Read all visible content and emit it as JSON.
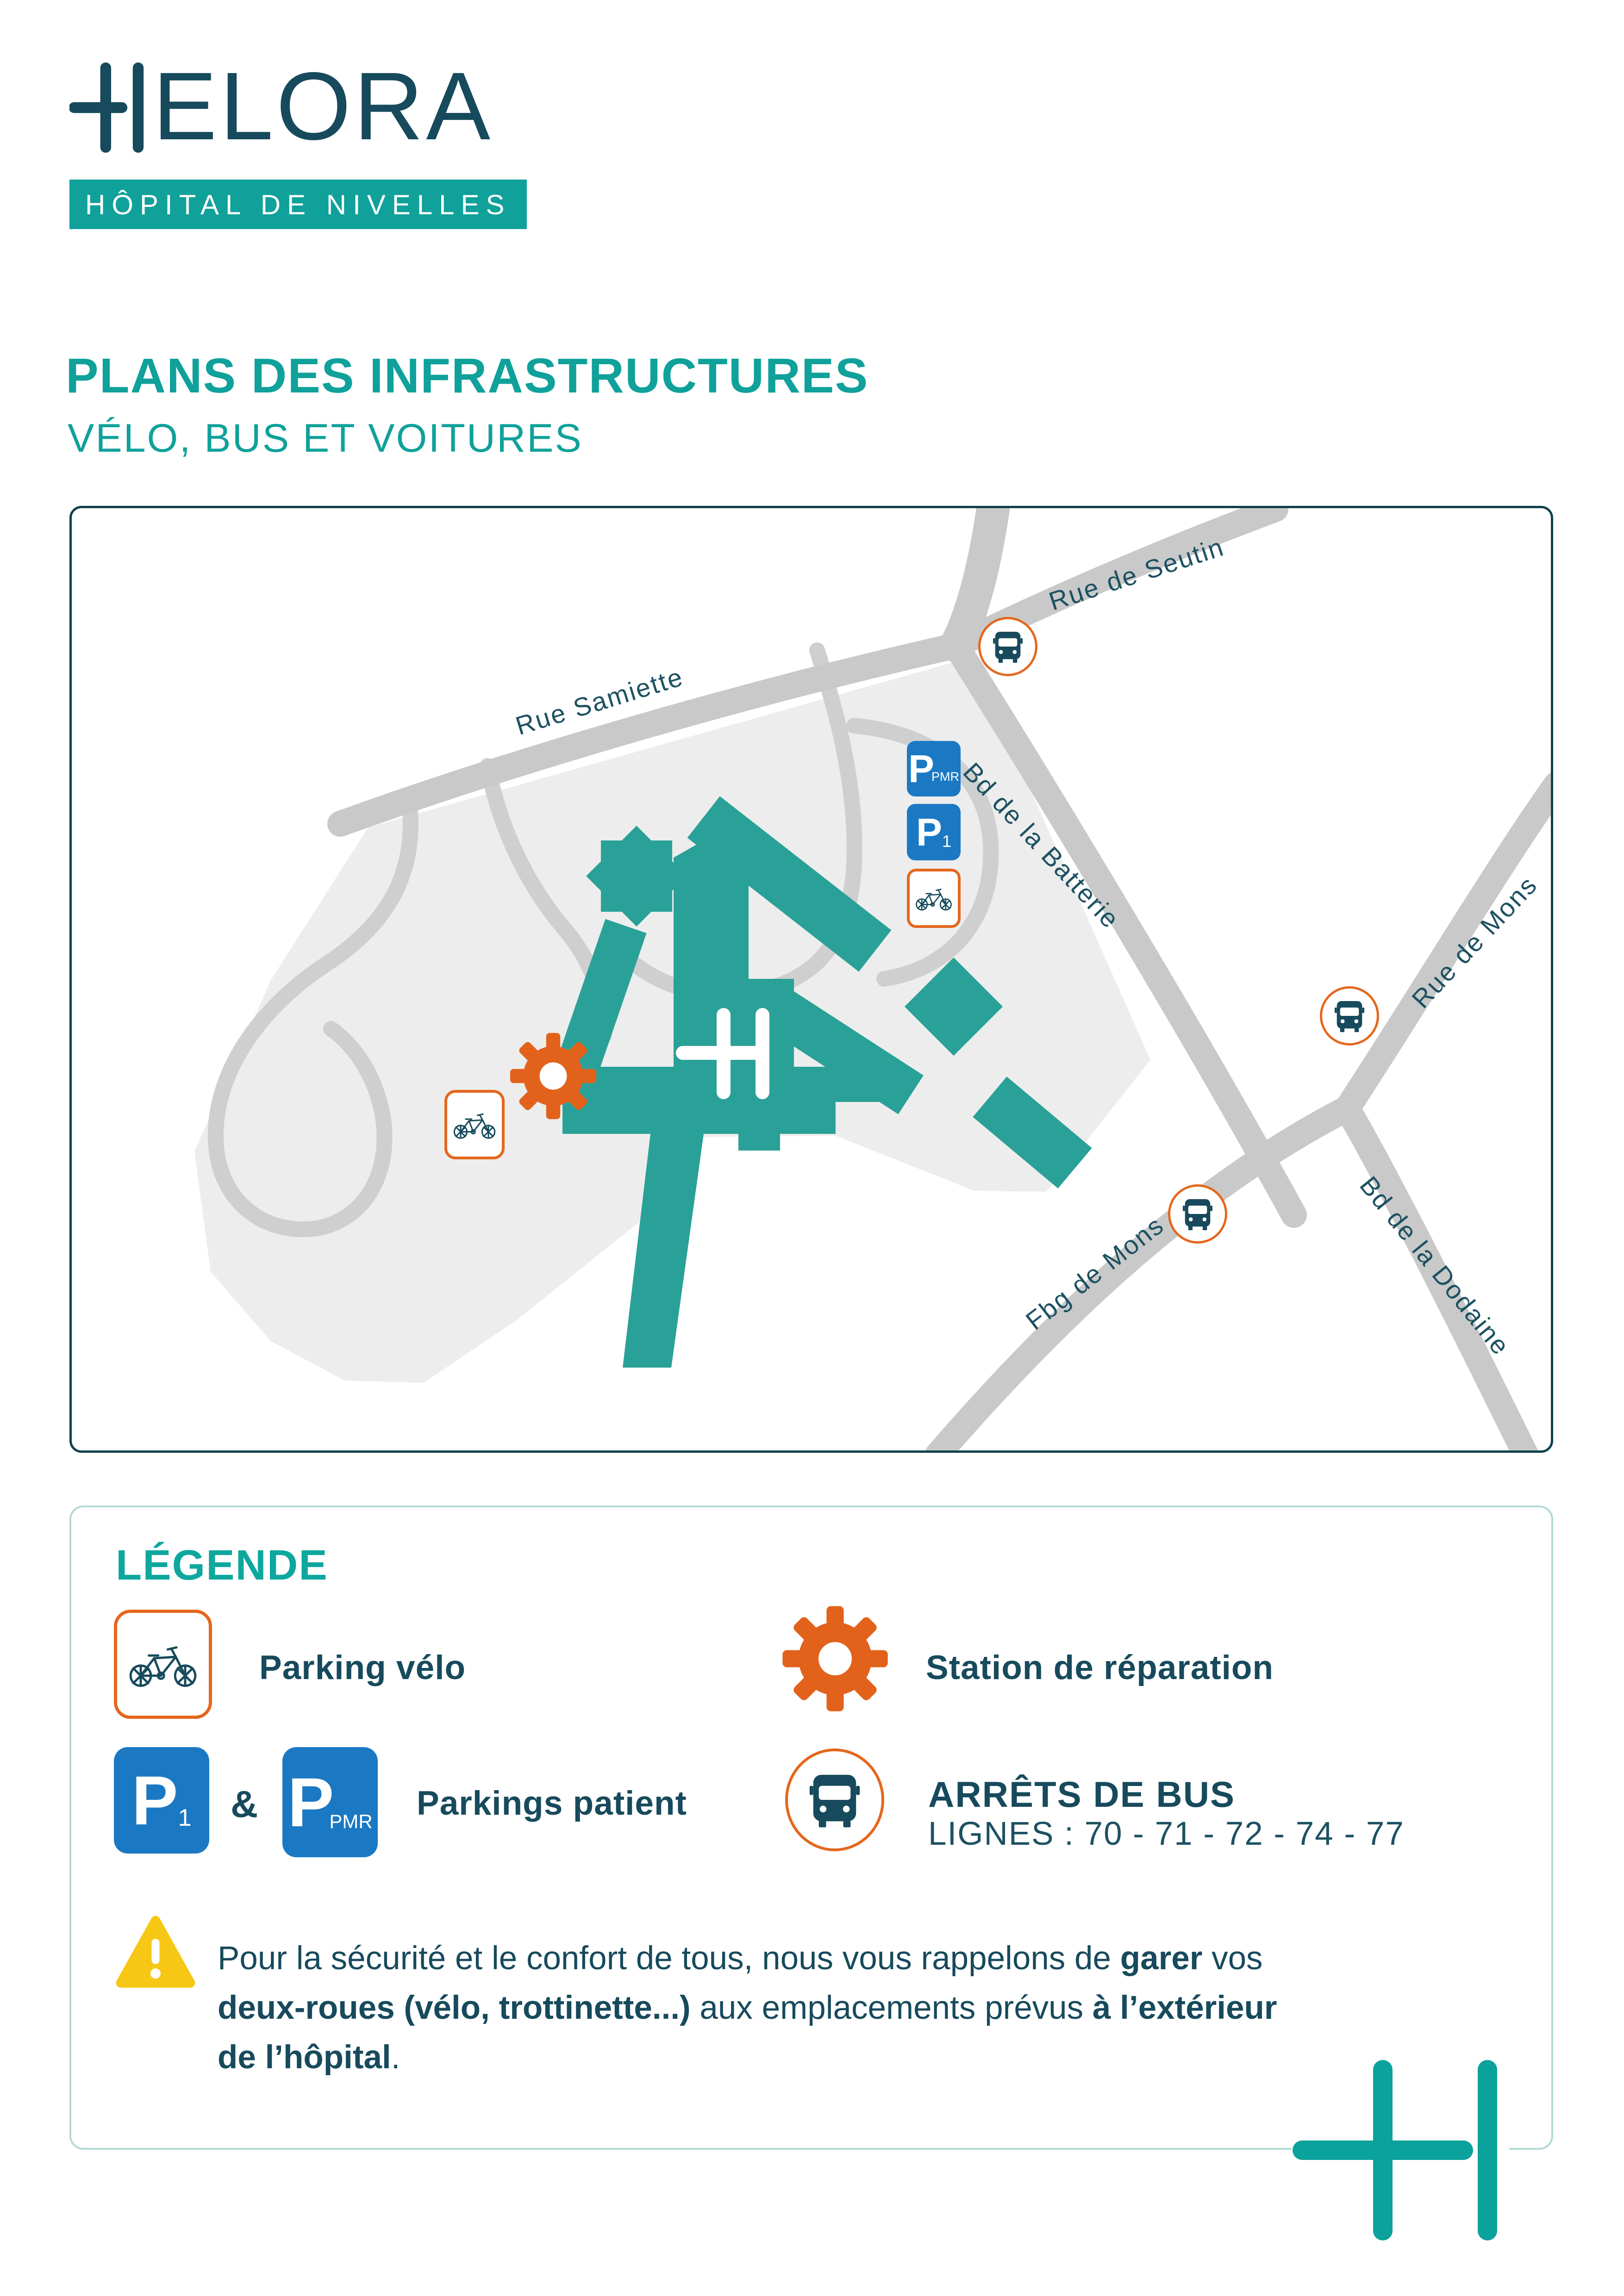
{
  "brand": {
    "wordmark_suffix": "ELORA",
    "banner": "HÔPITAL DE NIVELLES"
  },
  "title": "PLANS DES INFRASTRUCTURES",
  "subtitle": "VÉLO, BUS ET VOITURES",
  "map": {
    "streets": [
      "Rue de Seutin",
      "Rue Samiette",
      "Bd de la Batterie",
      "Rue de Mons",
      "Bd de la Dodaine",
      "Fbg de Mons"
    ],
    "signs": {
      "p": "P",
      "pmr": "PMR",
      "one": "1"
    }
  },
  "legend": {
    "heading": "LÉGENDE",
    "items": [
      {
        "label": "Parking vélo"
      },
      {
        "label": "Station de réparation"
      },
      {
        "amp": "&",
        "label": "Parkings patient"
      },
      {
        "label": "ARRÊTS DE BUS",
        "sub": "LIGNES : 70 - 71 - 72 - 74 - 77"
      }
    ],
    "warning": {
      "l1_pre": "Pour la sécurité et le confort de tous, nous vous rappelons de ",
      "l1_bold": "garer",
      "l1_post": " vos",
      "l2_bold": "deux-roues (vélo, trottinette...)",
      "l2_mid": " aux emplacements prévus ",
      "l2_bold2": "à l’extérieur",
      "l3_bold": "de l’hôpital",
      "l3_post": "."
    }
  },
  "colors": {
    "brand_teal": "#0FA19A",
    "dark_teal_text": "#174A5C",
    "building_teal": "#2AA198",
    "road_gray": "#C9C9C9",
    "campus_gray": "#EDEDED",
    "parking_blue": "#1B79C4",
    "orange": "#E2621B",
    "warning_yellow": "#F6C714",
    "legend_border": "#B2D9D5",
    "map_border": "#10404E"
  }
}
